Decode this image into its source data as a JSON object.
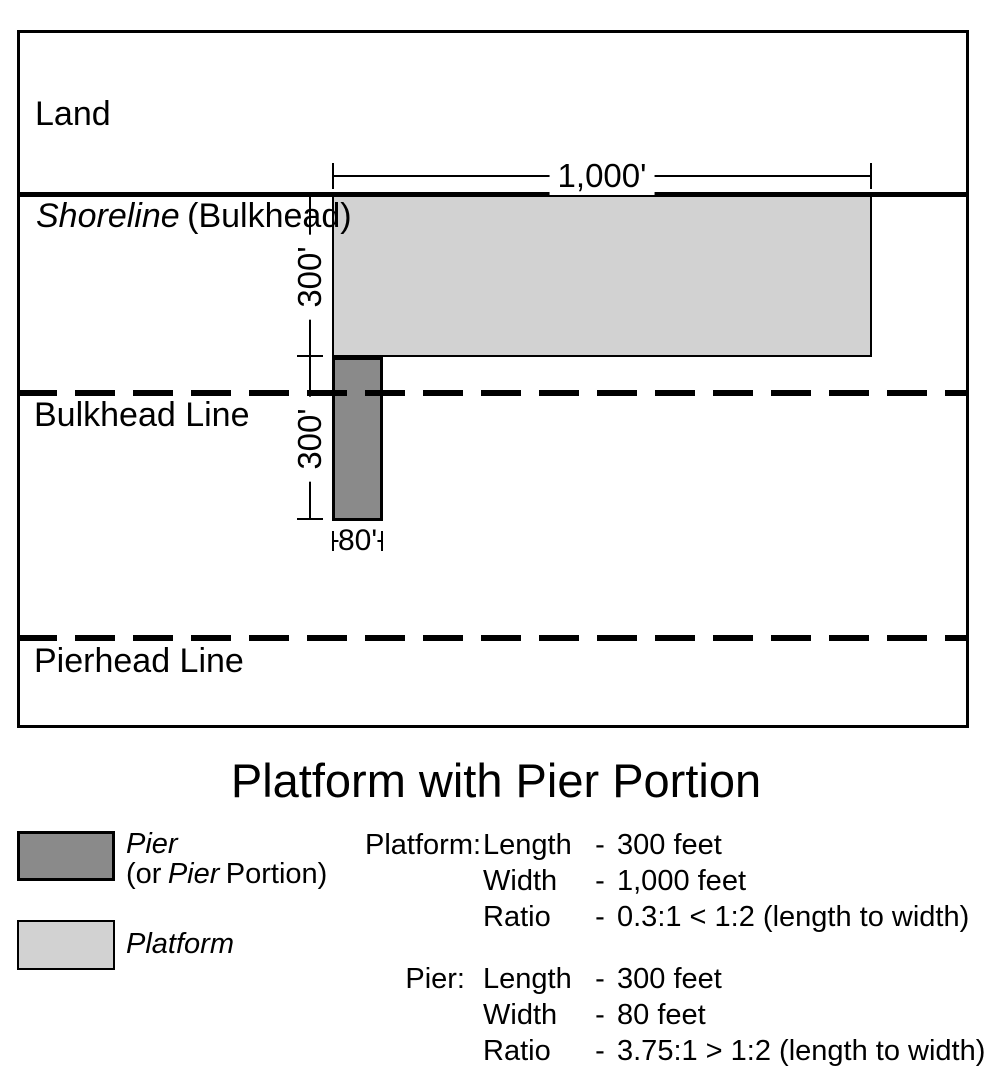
{
  "title": "Platform with Pier Portion",
  "colors": {
    "pier_fill": "#8a8a8a",
    "platform_fill": "#d2d2d2",
    "line": "#000000"
  },
  "diagram": {
    "land_label": "Land",
    "shoreline_label_italic": "Shoreline",
    "shoreline_label_rest": "(Bulkhead)",
    "bulkhead_line_label": "Bulkhead Line",
    "pierhead_line_label": "Pierhead Line",
    "platform_width_dim": "1,000'",
    "platform_length_dim": "300'",
    "pier_length_dim": "300'",
    "pier_width_dim": "80'"
  },
  "legend": {
    "pier_line1": "Pier",
    "pier_line2_prefix": "(or",
    "pier_line2_italic": "Pier",
    "pier_line2_suffix": "Portion)",
    "platform_label": "Platform"
  },
  "specs": {
    "platform": {
      "heading": "Platform:",
      "rows": [
        {
          "key": "Length",
          "dash": "-",
          "value": "300 feet"
        },
        {
          "key": "Width",
          "dash": "-",
          "value": "1,000 feet"
        },
        {
          "key": "Ratio",
          "dash": "-",
          "value": "0.3:1 < 1:2 (length to width)"
        }
      ]
    },
    "pier": {
      "heading": "Pier:",
      "rows": [
        {
          "key": "Length",
          "dash": "-",
          "value": "300 feet"
        },
        {
          "key": "Width",
          "dash": "-",
          "value": "80 feet"
        },
        {
          "key": "Ratio",
          "dash": "-",
          "value": "3.75:1 > 1:2 (length to width)"
        }
      ]
    }
  }
}
